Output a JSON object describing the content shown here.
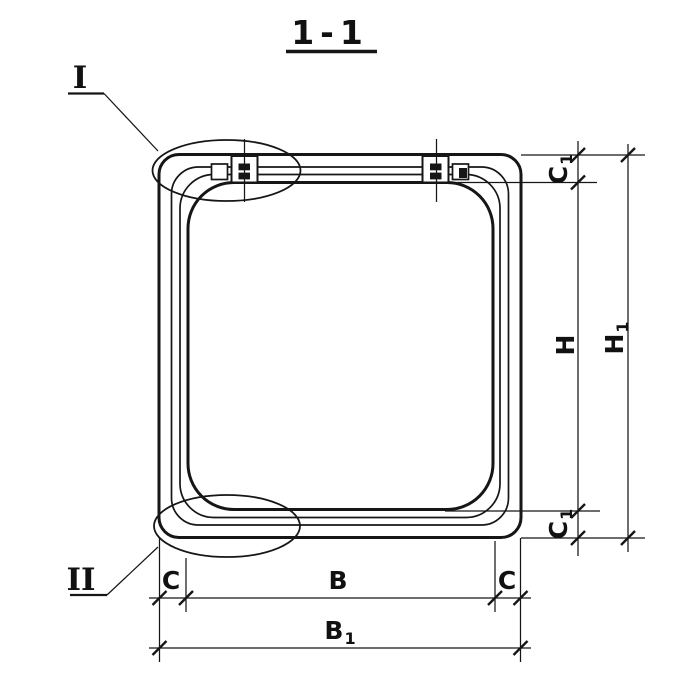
{
  "title": {
    "label": "1-1"
  },
  "detail_markers": {
    "top": {
      "label": "I"
    },
    "bottom": {
      "label": "II"
    }
  },
  "dimensions": {
    "c1_top": {
      "base": "C",
      "sub": "1"
    },
    "h": {
      "base": "H",
      "sub": ""
    },
    "c1_bottom": {
      "base": "C",
      "sub": "1"
    },
    "h1": {
      "base": "H",
      "sub": "1"
    },
    "c_left": {
      "base": "C",
      "sub": ""
    },
    "b": {
      "base": "B",
      "sub": ""
    },
    "c_right": {
      "base": "C",
      "sub": ""
    },
    "b1": {
      "base": "B",
      "sub": "1"
    }
  },
  "colors": {
    "ink": "#161616",
    "paper": "#ffffff"
  }
}
